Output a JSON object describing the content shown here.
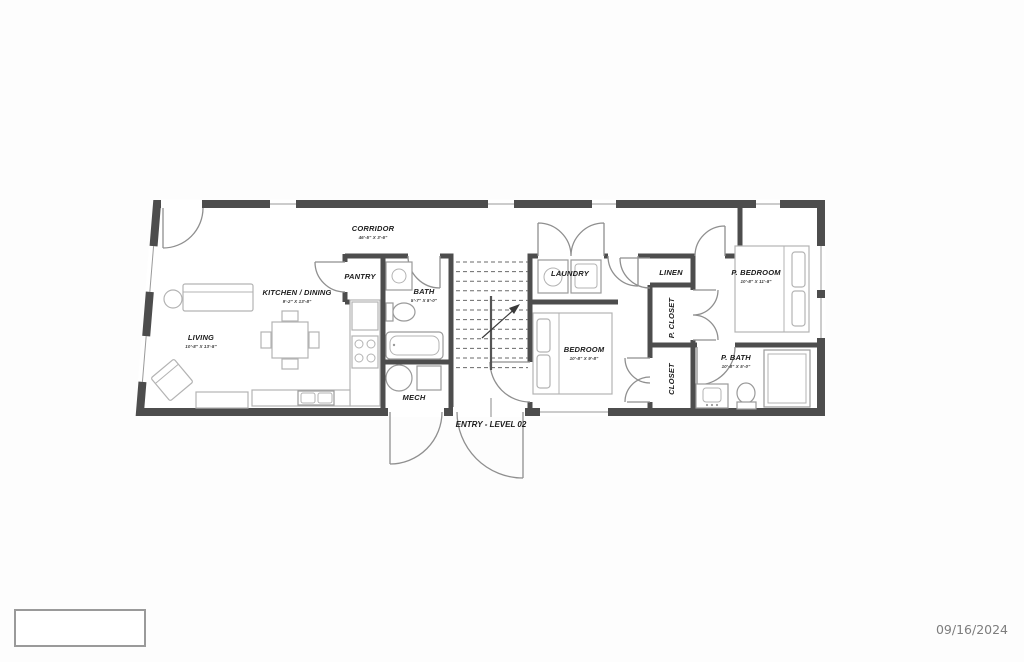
{
  "footer": {
    "date": "09/16/2024"
  },
  "rooms": {
    "corridor": {
      "label": "CORRIDOR",
      "dim": "46'-5\" X 3'-6\""
    },
    "living": {
      "label": "LIVING",
      "dim": "10'-8\" X 13'-8\""
    },
    "kitchen_dining": {
      "label": "KITCHEN / DINING",
      "dim": "9'-2\" X 13'-8\""
    },
    "pantry": {
      "label": "PANTRY"
    },
    "bath": {
      "label": "BATH",
      "dim": "5'-7\" X 8'-0\""
    },
    "mech": {
      "label": "MECH"
    },
    "laundry": {
      "label": "LAUNDRY"
    },
    "linen": {
      "label": "LINEN"
    },
    "p_closet": {
      "label": "P. CLOSET"
    },
    "closet": {
      "label": "CLOSET"
    },
    "bedroom": {
      "label": "BEDROOM",
      "dim": "10'-8\" X 9'-8\""
    },
    "p_bedroom": {
      "label": "P. BEDROOM",
      "dim": "10'-8\" X 11'-8\""
    },
    "p_bath": {
      "label": "P. BATH",
      "dim": "10'-8\" X 5'-0\""
    }
  },
  "annotations": {
    "entry_label": "ENTRY - LEVEL 02"
  },
  "colors": {
    "wall": "#4d4d4d",
    "door_swing": "#8f8f8f",
    "furniture": "#b3b3b3",
    "label_text": "#1b1b1b",
    "date_text": "#7d7d7d"
  }
}
